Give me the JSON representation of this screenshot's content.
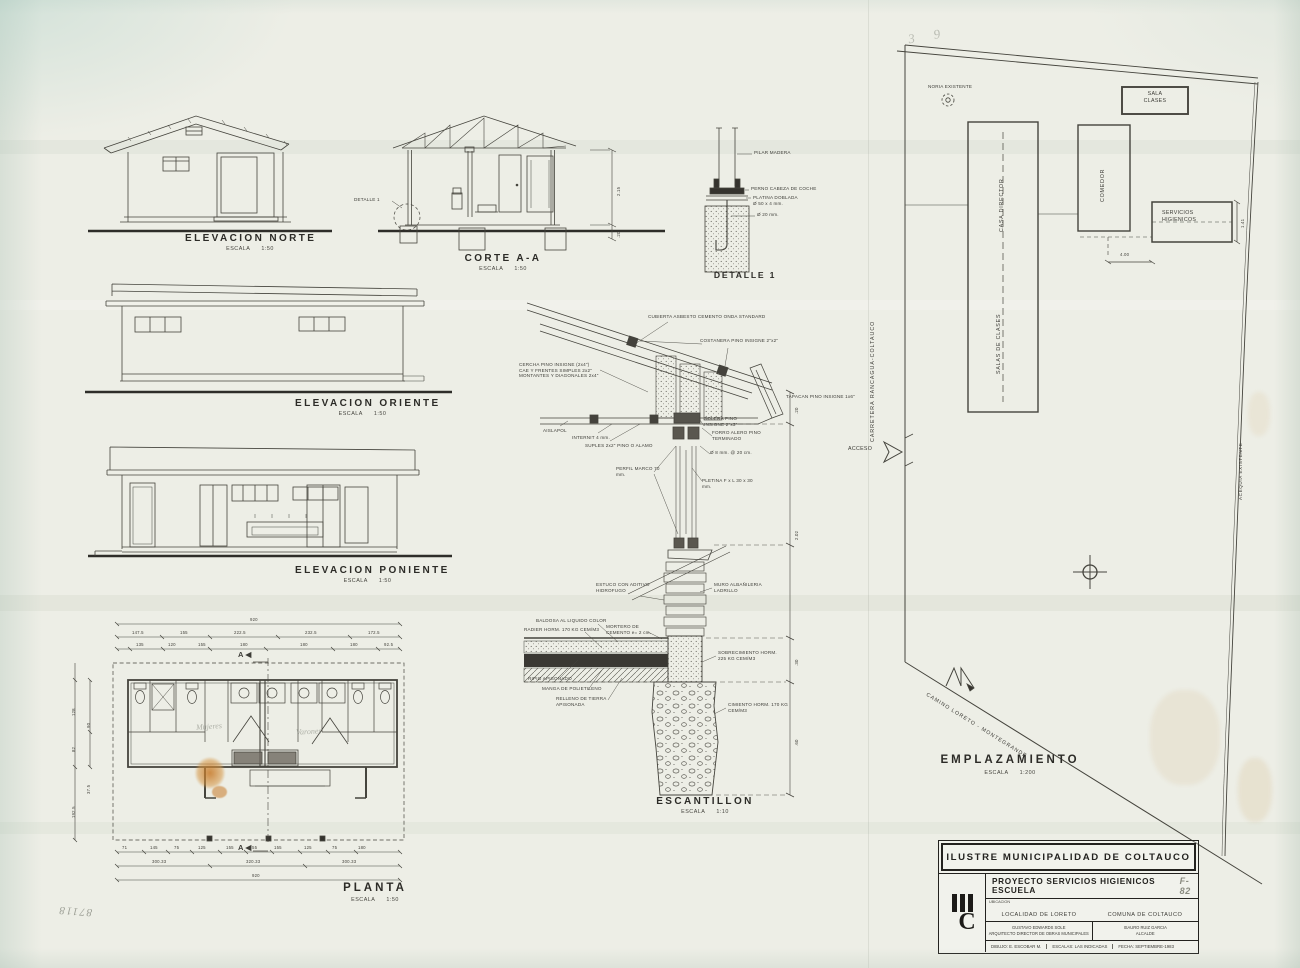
{
  "sheet": {
    "paper_color": "#edeee6",
    "ink_color": "#3d3c37"
  },
  "handwriting": {
    "corner_number": "87118",
    "top_marks": "3  9",
    "room_left": "Mujeres",
    "room_right": "Varones"
  },
  "drawings": {
    "elevacion_norte": {
      "title": "ELEVACION NORTE",
      "escala_label": "ESCALA",
      "scale": "1:50"
    },
    "corte_aa": {
      "title": "CORTE A-A",
      "escala_label": "ESCALA",
      "scale": "1:50",
      "detalle_ref": "DETALLE 1",
      "dim_wall": "2.15",
      "dim_base": ".20"
    },
    "detalle_1": {
      "title": "DETALLE 1",
      "pilar": "PILAR MADERA",
      "perno": "PERNO CABEZA DE COCHE",
      "platina_1": "PLATINA DOBLADA",
      "platina_2": "Ø 50 x 4 mm.",
      "diam": "Ø 20 mm."
    },
    "elevacion_oriente": {
      "title": "ELEVACION ORIENTE",
      "escala_label": "ESCALA",
      "scale": "1:50"
    },
    "elevacion_poniente": {
      "title": "ELEVACION PONIENTE",
      "escala_label": "ESCALA",
      "scale": "1:50"
    },
    "planta": {
      "title": "PLANTA",
      "escala_label": "ESCALA",
      "scale": "1:50",
      "section_marker": "A",
      "dim_total_top": "920",
      "dims_row2": [
        "147.5",
        "155",
        "222.5",
        "232.5",
        "172.5"
      ],
      "dims_row3": [
        "135",
        "120",
        "155",
        "180",
        "180",
        "180",
        "92.5"
      ],
      "dims_bottom_row1": [
        "71",
        "145",
        "75",
        "125",
        "155",
        "55",
        "155",
        "125",
        "75",
        "180"
      ],
      "dims_bottom_row2": [
        "300.33",
        "320.33",
        "300.33"
      ],
      "dim_total_bottom": "920",
      "dims_left": [
        "128",
        "82",
        "90",
        "192.5",
        "37.5"
      ]
    },
    "escantillon": {
      "title": "ESCANTILLON",
      "escala_label": "ESCALA",
      "scale": "1:10",
      "labels": {
        "cubierta": "CUBIERTA ASBESTO CEMENTO ONDA STANDARD",
        "costanera": "COSTANERA PINO INSIGNE 2\"x2\"",
        "cercha_1": "CERCHA PINO INSIGNE (2x4\")",
        "cercha_2": "CAE Y FRENTES SIMPLES 2x2\"",
        "cercha_3": "MONTANTES Y DIAGONALES 2x4\"",
        "tapacan": "TAPACAN PINO INSIGNE 1x6\"",
        "aislapol": "AISLAPOL",
        "internit": "INTERNIT 4 mm.",
        "suples": "SUPLES 2x2\" PINO O ALAMO",
        "solera": "SOLERA PINO INSIGNE 2\"x3\"",
        "forro": "FORRO ALERO PINO TERMINADO",
        "fierro": "Ø 8 mm. @ 20 cm.",
        "perfil_marco": "PERFIL MARCO 70 mm.",
        "pletina": "PLETINA F x L 30 x 30 mm.",
        "estuco": "ESTUCO CON ADITIVO HIDROFUGO",
        "muro": "MURO ALBAÑILERIA LADRILLO",
        "baldosa": "BALDOSA AL LIQUIDO COLOR",
        "radier": "RADIER HORM. 170 KG CEM/M3",
        "mortero": "MORTERO DE CEMENTO e= 2 cm.",
        "ripio": "RIPIO APISONADO",
        "manga": "MANGA DE POLIETILENO",
        "relleno": "RELLENO DE TIERRA APISONADA",
        "sobrecimiento": "SOBRECIMIENTO HORM. 225 KG CEM/M3",
        "cimiento": "CIMIENTO HORM. 170 KG CEM/M3"
      },
      "dims": {
        "top": ".20",
        "wall": "2.02",
        "sobrecimiento": ".30",
        "cimiento": ".60"
      }
    },
    "emplazamiento": {
      "title": "EMPLAZAMIENTO",
      "escala_label": "ESCALA",
      "scale": "1:200",
      "noria": "NORIA EXISTENTE",
      "sala_clases_1": "SALA",
      "sala_clases_2": "CLASES",
      "casa_director": "CASA DIRECTOR",
      "comedor": "COMEDOR",
      "servicios_1": "SERVICIOS",
      "servicios_2": "HIGIENICOS",
      "salas_clases": "SALAS DE CLASES",
      "carretera": "CARRETERA RANCAGUA-COLTAUCO",
      "camino": "CAMINO LORETO - MONTEGRANDE",
      "acequia": "ACEQUIA EXISTENTE",
      "acceso": "ACCESO",
      "dim_a": "4.00",
      "dim_b": "1.41"
    }
  },
  "title_block": {
    "municipality": "ILUSTRE MUNICIPALIDAD DE COLTAUCO",
    "project": "PROYECTO SERVICIOS HIGIENICOS ESCUELA",
    "sheet_no": "F-82",
    "ubicacion_label": "UBICACION",
    "localidad": "LOCALIDAD DE LORETO",
    "comuna": "COMUNA DE COLTAUCO",
    "architect_name": "GUSTAVO EDWARDS SOLE",
    "architect_title": "ARQUITECTO DIRECTOR DE OBRAS MUNICIPALES",
    "mayor_name": "ISAURO RUIZ GARCIA",
    "mayor_title": "ALCALDE",
    "dibujo": "DIBUJO: E. ESCOBAR M.",
    "escalas": "ESCALAS: LAS INDICADAS",
    "fecha": "FECHA: SEPTIEMBRE-1983",
    "logo_c": "C"
  }
}
